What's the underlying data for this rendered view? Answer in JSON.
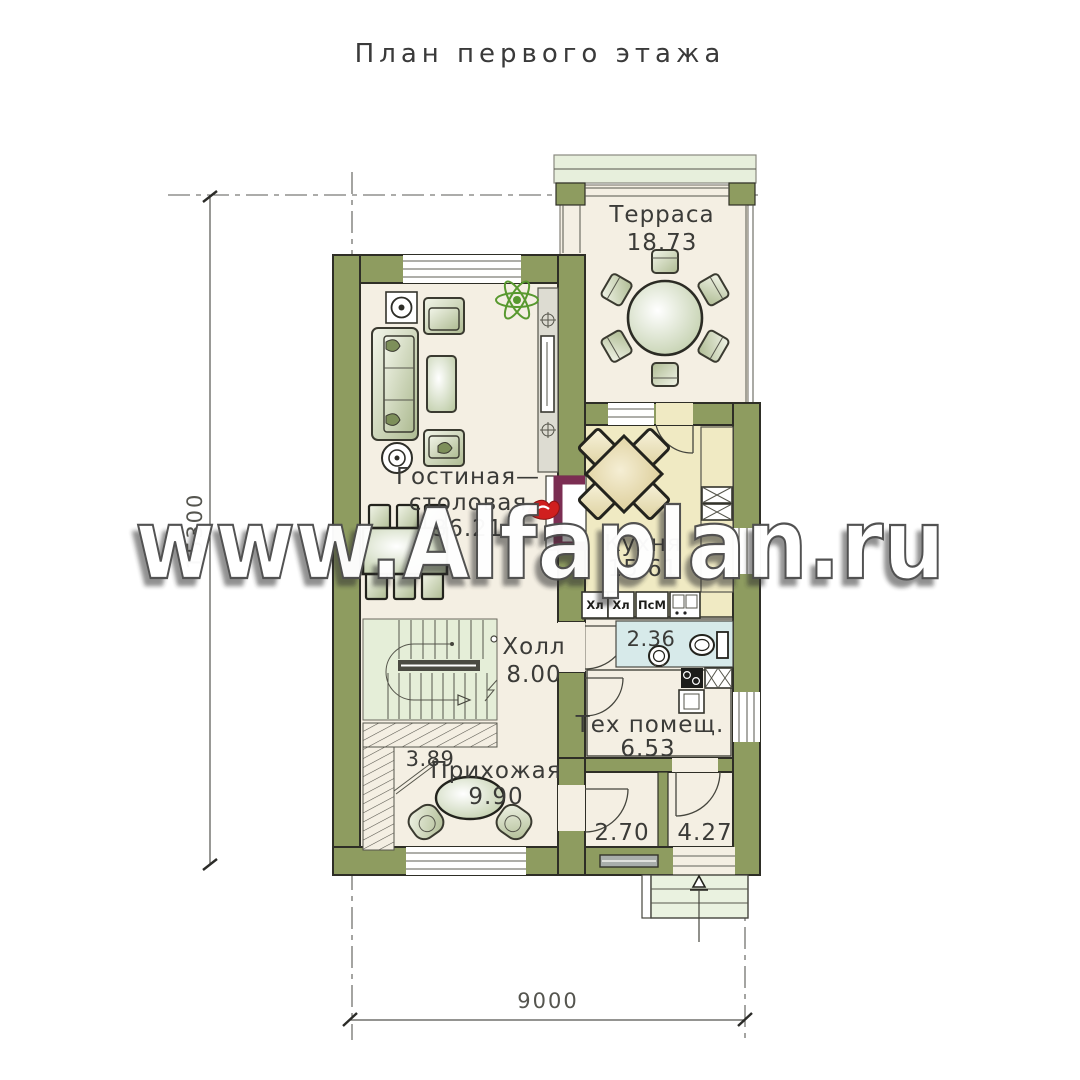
{
  "title": "План первого этажа",
  "watermark": "www.Alfaplan.ru",
  "dimensions": {
    "bottom": "9000",
    "left": "15300"
  },
  "rooms": {
    "terrace": {
      "name": "Терраса",
      "area": "18.73"
    },
    "living": {
      "name1": "Гостиная—",
      "name2": "столовая",
      "area": "36.21"
    },
    "kitchen": {
      "name": "Кухня",
      "area": "15.61"
    },
    "hall": {
      "name": "Холл",
      "area": "8.00"
    },
    "wc": {
      "area": "2.36"
    },
    "tech": {
      "name": "Тех помещ.",
      "area": "6.53"
    },
    "closet": {
      "area": "3.89"
    },
    "entry": {
      "name": "Прихожая",
      "area": "9.90"
    },
    "vestibule": {
      "area": "2.70"
    },
    "porch_room": {
      "area": "4.27"
    }
  },
  "kitchen_units": {
    "fridge_1": "Хл",
    "fridge_2": "Хл",
    "washer": "ПсМ"
  },
  "colors": {
    "wall": "#8e9c60",
    "floor": "#f4efe3",
    "kitchen_floor": "#f0eac3",
    "bath_floor": "#d7eaea",
    "stairs_floor": "#e5eed8",
    "fireplace": "#7b2d52",
    "flame": "#d01f1f",
    "plant": "#58992f"
  }
}
